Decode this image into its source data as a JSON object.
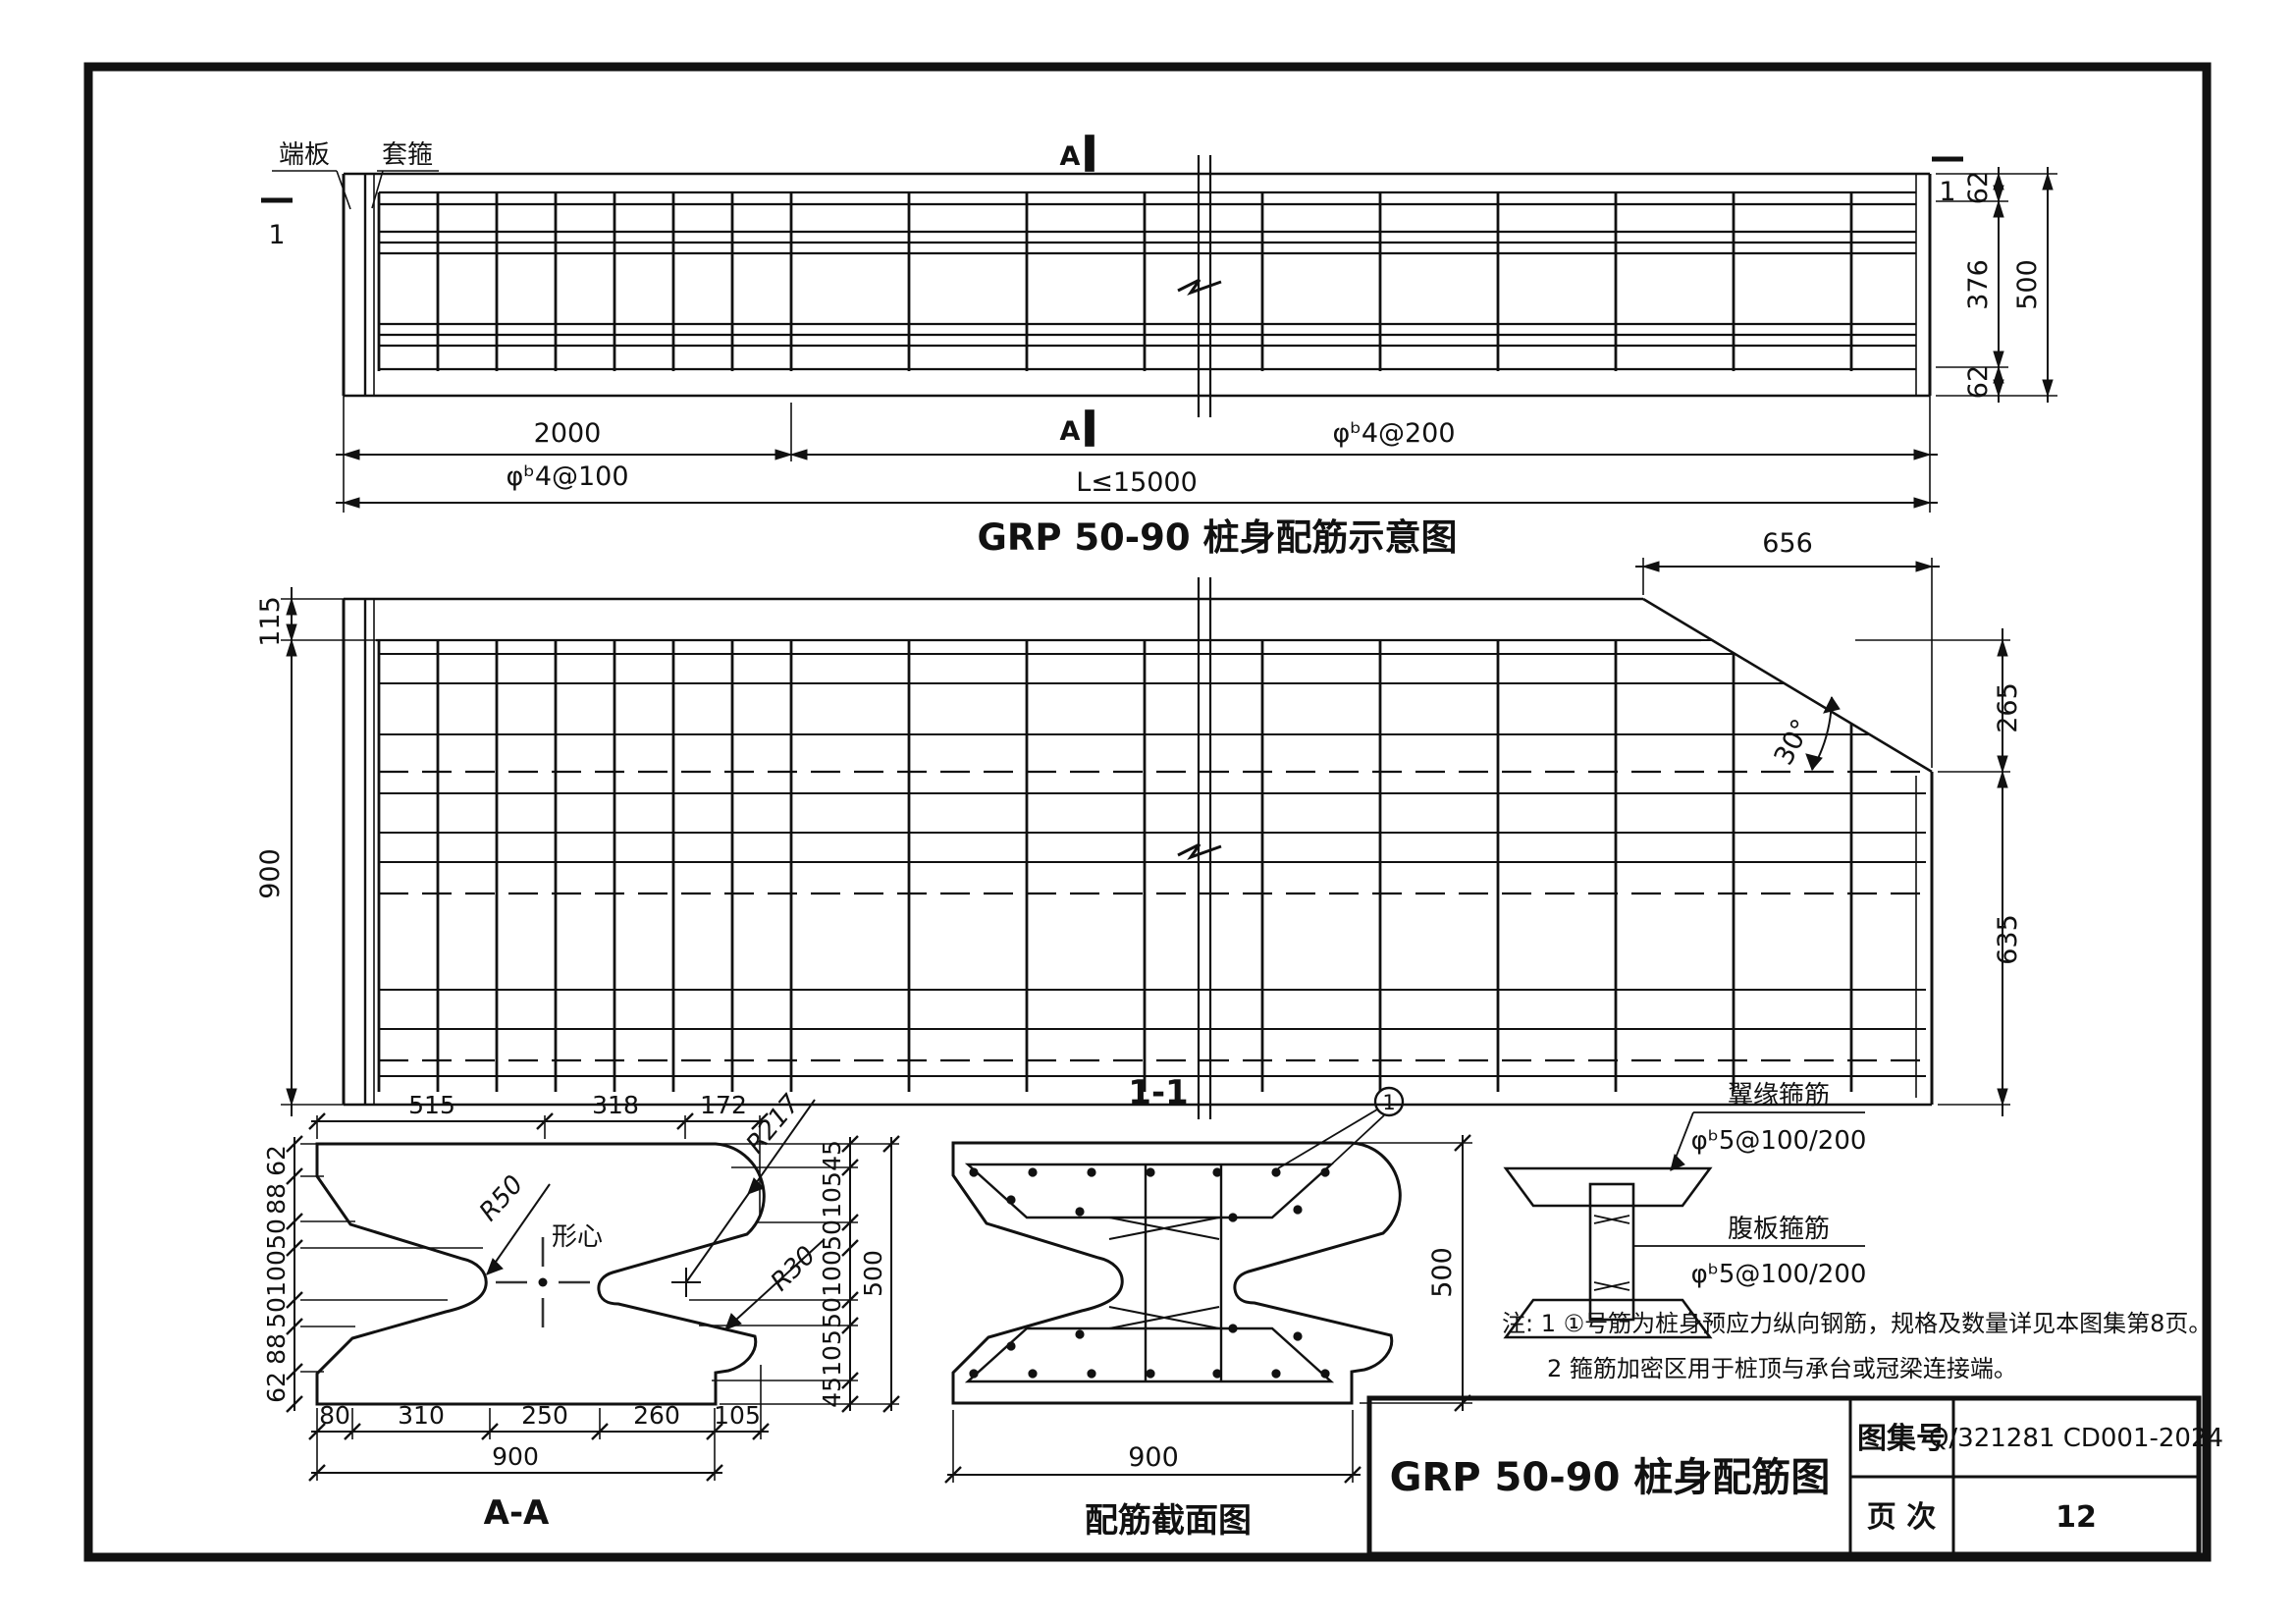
{
  "colors": {
    "ink": "#1a1a1a",
    "paper": "#ffffff"
  },
  "elevation": {
    "title": "GRP 50-90 桩身配筋示意图",
    "end_plate_label": "端板",
    "collar_label": "套箍",
    "section_mark_left": "1",
    "section_mark_right": "1",
    "section_letter": "A",
    "dims": {
      "dense_zone": "2000",
      "dense_spec": "φᵇ4@100",
      "sparse_spec": "φᵇ4@200",
      "total_length": "L≤15000",
      "right_top": "62",
      "right_mid": "376",
      "right_bottom": "62",
      "right_total": "500"
    }
  },
  "plan": {
    "dims": {
      "left_top": "115",
      "left_total": "900",
      "tip_run": "656",
      "right_upper": "265",
      "right_lower": "635",
      "tip_angle": "30°"
    }
  },
  "section_aa": {
    "title": "A-A",
    "centroid_label": "形心",
    "radius_labels": {
      "web": "R50",
      "nose": "R217",
      "cove": "R30"
    },
    "top": [
      "515",
      "318",
      "172"
    ],
    "left": [
      "62",
      "88",
      "50",
      "100",
      "50",
      "88",
      "62"
    ],
    "right": [
      "45",
      "105",
      "50",
      "100",
      "50",
      "105",
      "45"
    ],
    "right_total": "500",
    "bottom": [
      "80",
      "310",
      "250",
      "260",
      "105"
    ],
    "bottom_total": "900"
  },
  "section_11": {
    "title": "1-1",
    "caption": "配筋截面图",
    "tag": "1",
    "width": "900",
    "height": "500"
  },
  "detail": {
    "flange_label": "翼缘箍筋",
    "flange_spec": "φᵇ5@100/200",
    "web_label": "腹板箍筋",
    "web_spec": "φᵇ5@100/200"
  },
  "notes": {
    "line1": "注: 1 ①号筋为桩身预应力纵向钢筋，规格及数量详见本图集第8页。",
    "line2": "2 箍筋加密区用于桩顶与承台或冠梁连接端。"
  },
  "title_block": {
    "drawing_title": "GRP 50-90 桩身配筋图",
    "atlas_label": "图集号",
    "atlas_number": "Q/321281 CD001-2024",
    "page_label": "页  次",
    "page_number": "12"
  }
}
